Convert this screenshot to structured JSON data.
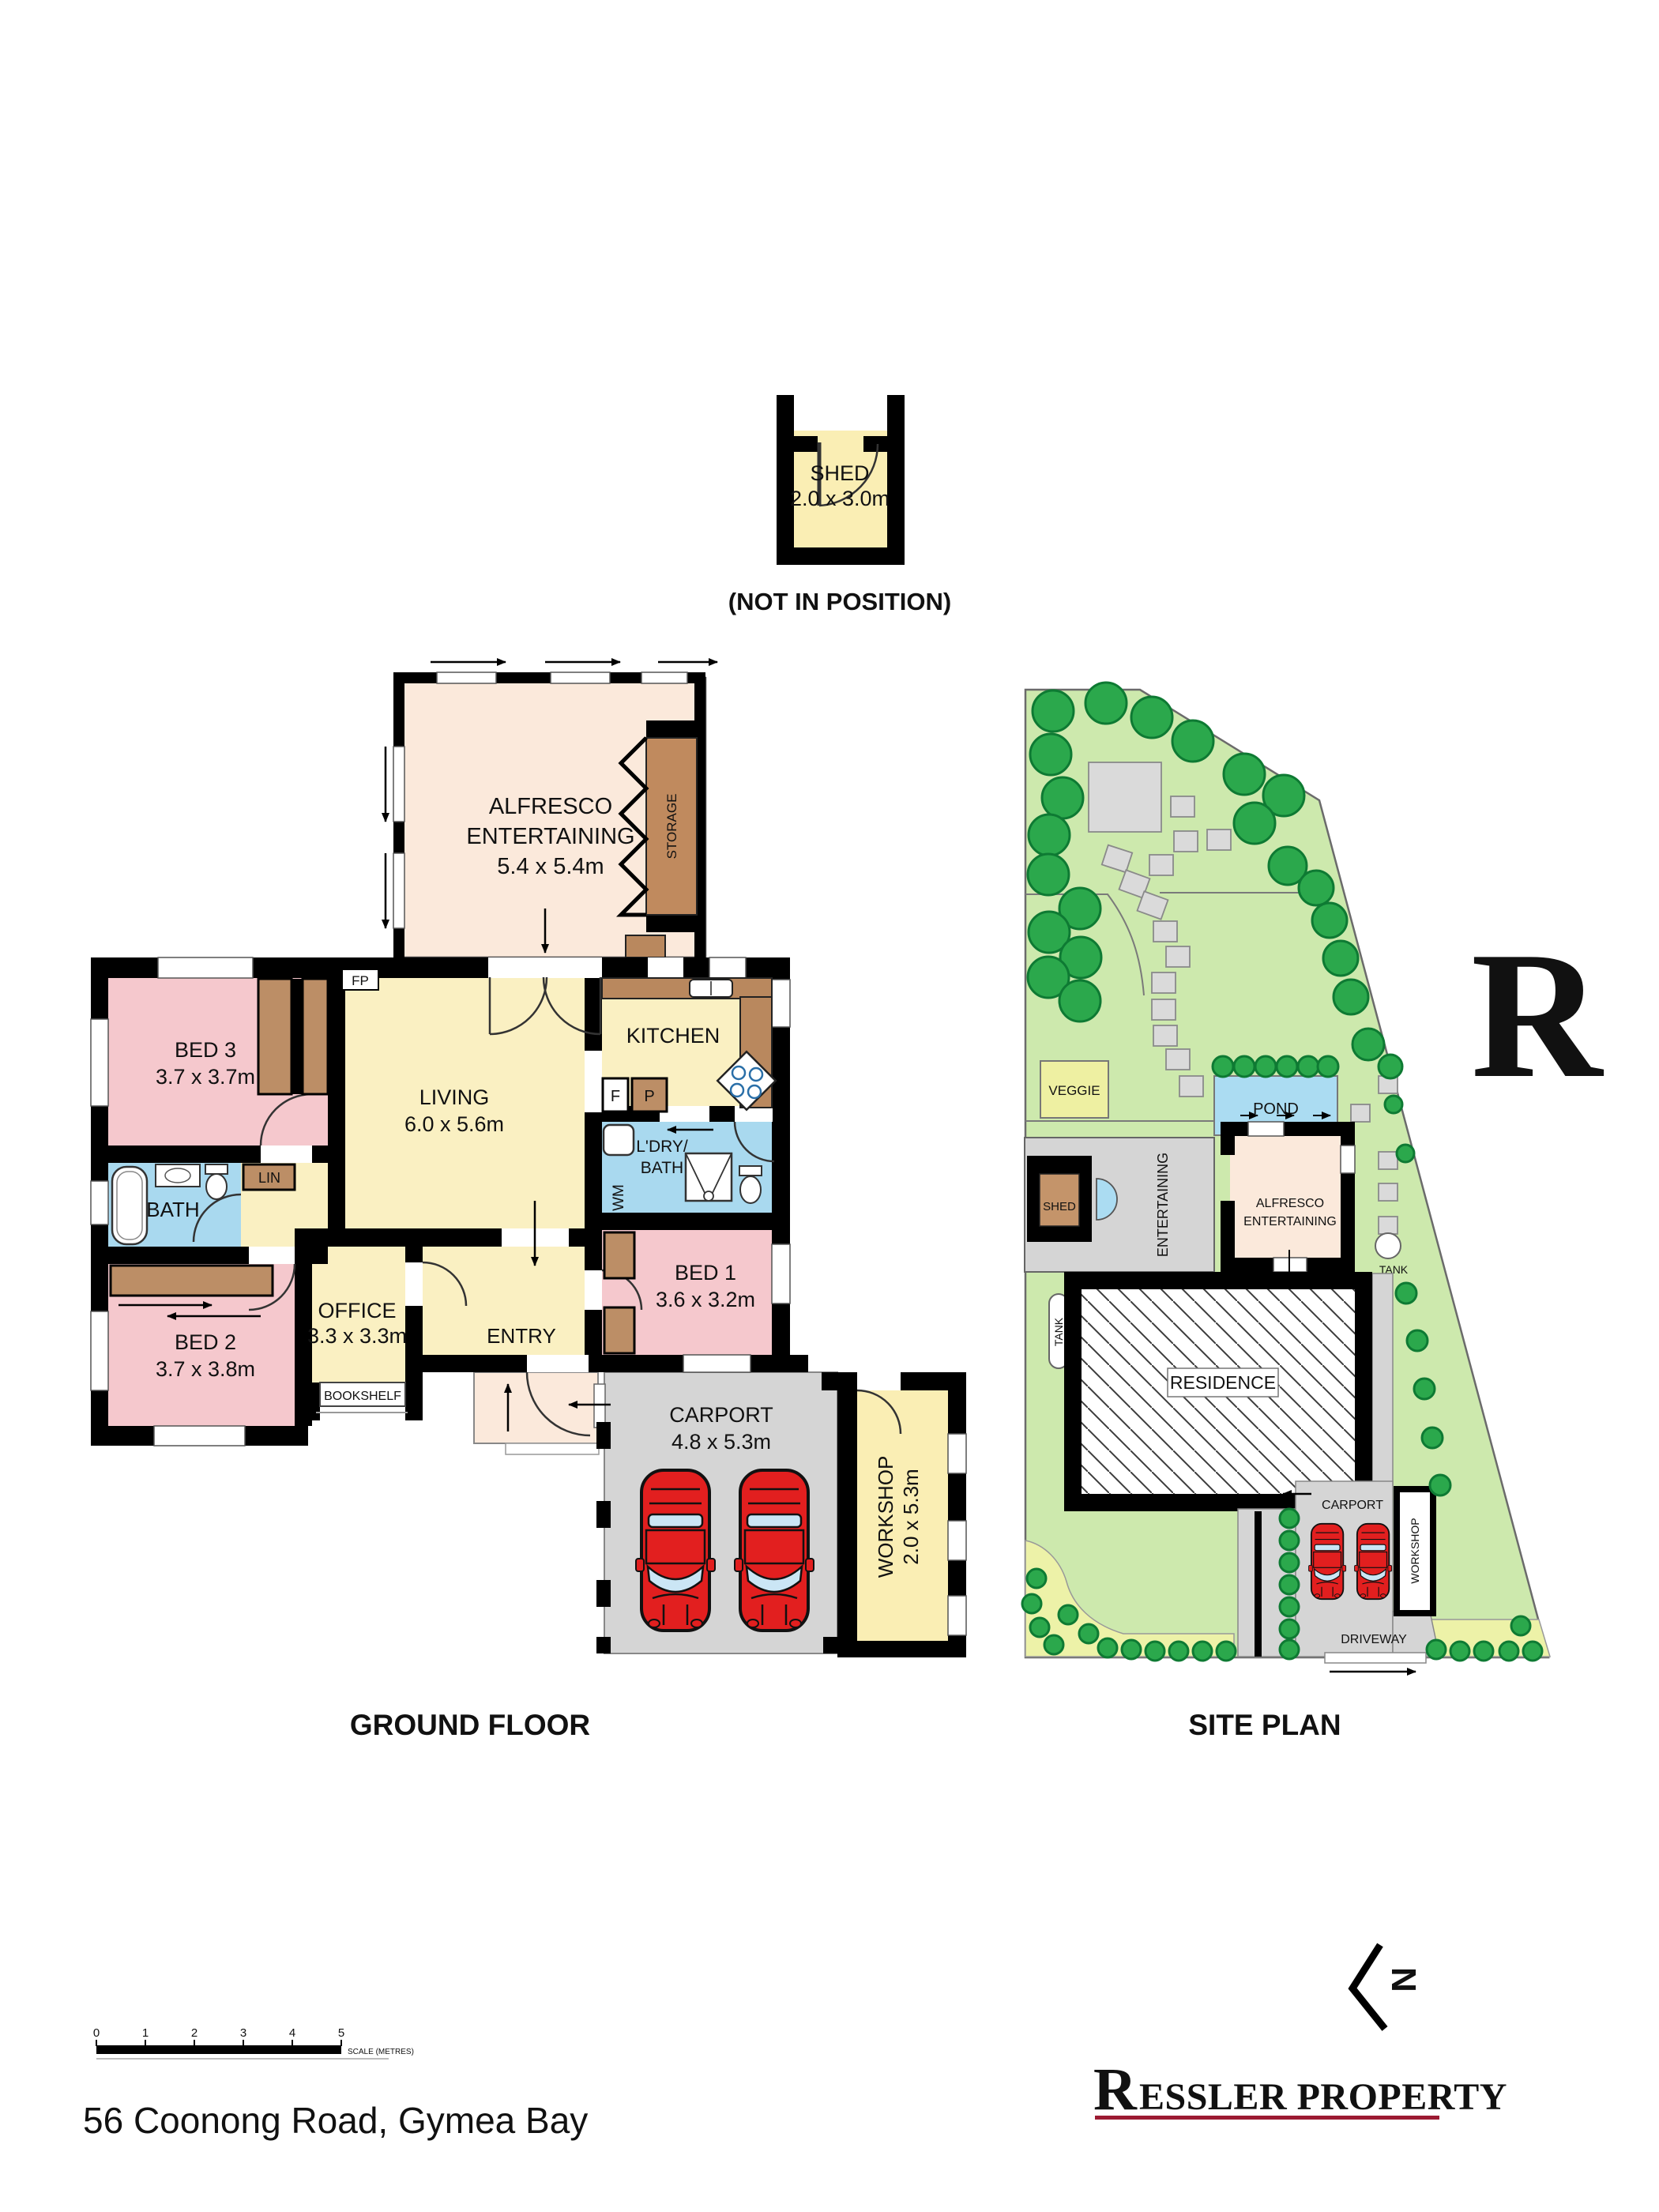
{
  "titles": {
    "ground_floor": "GROUND FLOOR",
    "site_plan": "SITE PLAN",
    "not_in_position": "(NOT IN POSITION)"
  },
  "floorplan": {
    "shed": {
      "name": "SHED",
      "dims": "2.0 x 3.0m"
    },
    "alfresco": {
      "name_line1": "ALFRESCO",
      "name_line2": "ENTERTAINING",
      "dims": "5.4 x 5.4m"
    },
    "storage": "STORAGE",
    "fireplace": "FP",
    "living": {
      "name": "LIVING",
      "dims": "6.0 x 5.6m"
    },
    "kitchen": {
      "name": "KITCHEN",
      "fridge": "F",
      "pantry": "P"
    },
    "laundry": {
      "line1": "L'DRY/",
      "line2": "BATH",
      "wm": "WM"
    },
    "bath": "BATH",
    "linen": "LIN",
    "bed1": {
      "name": "BED 1",
      "dims": "3.6 x 3.2m"
    },
    "bed2": {
      "name": "BED 2",
      "dims": "3.7 x 3.8m"
    },
    "bed3": {
      "name": "BED 3",
      "dims": "3.7 x 3.7m"
    },
    "office": {
      "name": "OFFICE",
      "dims": "3.3 x 3.3m"
    },
    "entry": "ENTRY",
    "bookshelf": "BOOKSHELF",
    "carport": {
      "name": "CARPORT",
      "dims": "4.8 x 5.3m"
    },
    "workshop": {
      "name": "WORKSHOP",
      "dims": "2.0 x 5.3m"
    }
  },
  "siteplan": {
    "veggie": "VEGGIE",
    "pond": "POND",
    "shed": "SHED",
    "entertaining": "ENTERTAINING",
    "alfresco_line1": "ALFRESCO",
    "alfresco_line2": "ENTERTAINING",
    "tank_right": "TANK",
    "tank_left": "TANK",
    "residence": "RESIDENCE",
    "carport": "CARPORT",
    "workshop": "WORKSHOP",
    "driveway": "DRIVEWAY"
  },
  "scale_bar": {
    "ticks": [
      "0",
      "1",
      "2",
      "3",
      "4",
      "5"
    ],
    "caption": "SCALE (METRES)"
  },
  "footer": {
    "address": "56 Coonong Road, Gymea Bay",
    "brand_initial": "R",
    "brand_rest": "ESSLER PROPERTY",
    "watermark_letter": "R",
    "compass_letter": "N"
  },
  "colors": {
    "wall": "#000000",
    "bedroom_pink": "#F5C8CD",
    "living_yellow": "#FAF0C2",
    "workshop_yellow": "#FAEEB4",
    "bath_blue": "#A9D9EF",
    "alfresco_cream": "#FBE9DB",
    "robe_brown": "#BC8E66",
    "counter_brown": "#B9885E",
    "carport_gray": "#D5D5D5",
    "lawn_green": "#CDE9AD",
    "tree_green": "#2BA84C",
    "pond_blue": "#ABDCF2",
    "veggie_yellow": "#EEF0A2",
    "garden_yellow": "#EDF2A8",
    "car_red": "#E21F1F",
    "brand": "#9C1B33",
    "watermark": "#B4566E"
  }
}
